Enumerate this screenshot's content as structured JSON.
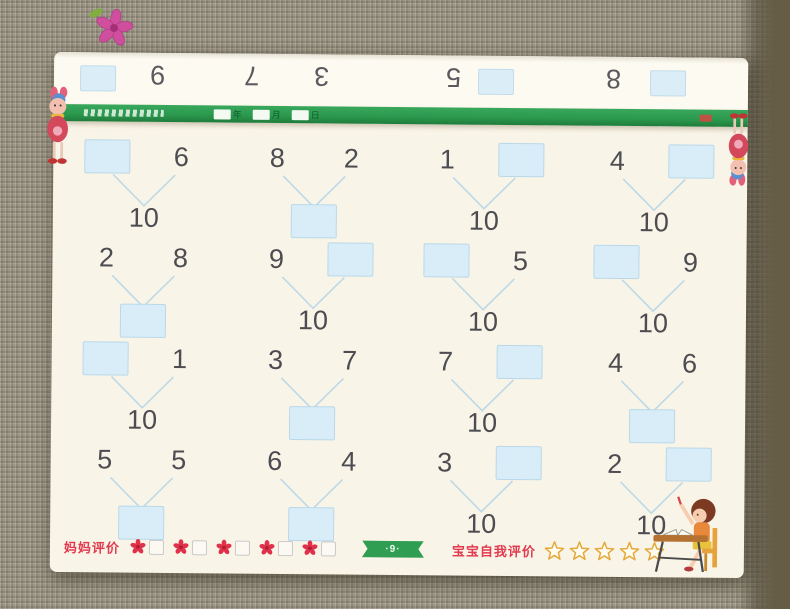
{
  "scene": {
    "decor_icons": {
      "top_left": "pink-flower-fabric-decor",
      "page_left": "doll-mascot",
      "page_right": "doll-mascot-upside-down",
      "bottom_right": "girl-at-desk-illustration"
    }
  },
  "worksheet": {
    "peek_row": {
      "note_icon": "upside-down-previous-page-edge",
      "items": [
        {
          "type": "box",
          "x": 26
        },
        {
          "type": "number",
          "value": "9",
          "x": 96
        },
        {
          "type": "number",
          "value": "7",
          "x": 190
        },
        {
          "type": "number",
          "value": "3",
          "x": 260
        },
        {
          "type": "number",
          "value": "5",
          "x": 392
        },
        {
          "type": "box",
          "x": 424
        },
        {
          "type": "number",
          "value": "8",
          "x": 552
        },
        {
          "type": "box",
          "x": 596
        }
      ]
    },
    "band": {
      "title_chip_icon": "illegible-small-print",
      "date_fields": [
        "年",
        "月",
        "日"
      ]
    },
    "problems": [
      {
        "left": null,
        "right": "6",
        "bottom": "10"
      },
      {
        "left": "8",
        "right": "2",
        "bottom": null
      },
      {
        "left": "1",
        "right": null,
        "bottom": "10"
      },
      {
        "left": "4",
        "right": null,
        "bottom": "10"
      },
      {
        "left": "2",
        "right": "8",
        "bottom": null
      },
      {
        "left": "9",
        "right": null,
        "bottom": "10"
      },
      {
        "left": null,
        "right": "5",
        "bottom": "10"
      },
      {
        "left": null,
        "right": "9",
        "bottom": "10"
      },
      {
        "left": null,
        "right": "1",
        "bottom": "10"
      },
      {
        "left": "3",
        "right": "7",
        "bottom": null
      },
      {
        "left": "7",
        "right": null,
        "bottom": "10"
      },
      {
        "left": "4",
        "right": "6",
        "bottom": null
      },
      {
        "left": "5",
        "right": "5",
        "bottom": null
      },
      {
        "left": "6",
        "right": "4",
        "bottom": null
      },
      {
        "left": "3",
        "right": null,
        "bottom": "10"
      },
      {
        "left": "2",
        "right": null,
        "bottom": "10"
      }
    ],
    "footer": {
      "mom_label": "妈妈评价",
      "flower_slots": 5,
      "flower_icon": "red-plum-flower",
      "page_badge": "·9·",
      "baby_label": "宝宝自我评价",
      "star_count": 5,
      "star_icon": "gold-outline-star"
    },
    "colors": {
      "paper": "#f9f4e8",
      "band_green": "#2f9e53",
      "answer_box_blue": "#d9edf8",
      "answer_box_border": "#b9d8e9",
      "connector_blue": "#bcd9e8",
      "label_red": "#e23a4e",
      "star_gold": "#e5a93c",
      "number_ink": "#4c4c51"
    }
  }
}
